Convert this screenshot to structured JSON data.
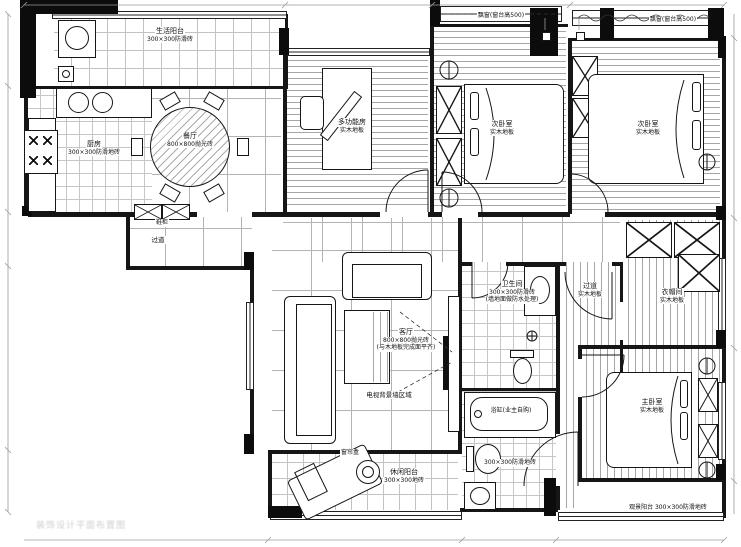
{
  "plan": {
    "rooms": {
      "service_balcony": {
        "name": "生活阳台",
        "floor": "300×300防滑砖"
      },
      "kitchen": {
        "name": "厨房",
        "floor": "300×300防滑地砖"
      },
      "dining": {
        "name": "餐厅",
        "floor": "800×800抛光砖"
      },
      "study": {
        "name": "多功能房",
        "floor": "实木地板"
      },
      "bedroom_a": {
        "name": "次卧室",
        "floor": "实木地板"
      },
      "bedroom_b": {
        "name": "次卧室",
        "floor": "实木地板"
      },
      "closet": {
        "name": "衣帽间",
        "floor": "实木地板"
      },
      "master": {
        "name": "主卧室",
        "floor": "实木地板"
      },
      "living": {
        "name": "客厅",
        "floor": "800×800抛光砖",
        "note": "(与木地板完成面平齐)"
      },
      "hall": {
        "name": "过道",
        "floor": "实木地板"
      },
      "bath1": {
        "name": "卫生间",
        "floor": "300×300防滑砖",
        "note": "(墙地面做防水处理)"
      },
      "bath2": {
        "floor": "300×300防滑地砖"
      },
      "leisure_balcony": {
        "name": "休闲阳台",
        "floor": "300×300地砖"
      },
      "view_balcony": {
        "name": "观景阳台 300×300防滑地砖"
      },
      "corridor": {
        "name": "过道"
      }
    },
    "annotations": {
      "bathtub": "浴缸(业主自购)",
      "curtain_box": "窗帘盒",
      "bay_window_left": "飘窗(窗台高500)",
      "bay_window_right": "飘窗(窗台高500)",
      "shoe_cabinet": "鞋柜",
      "tv_wall": "电视背景墙区域"
    },
    "watermark": "装饰设计平面布置图",
    "colors": {
      "line": "#161616",
      "grid": "#b3b3b3",
      "wood": "#a6a6a6"
    }
  }
}
